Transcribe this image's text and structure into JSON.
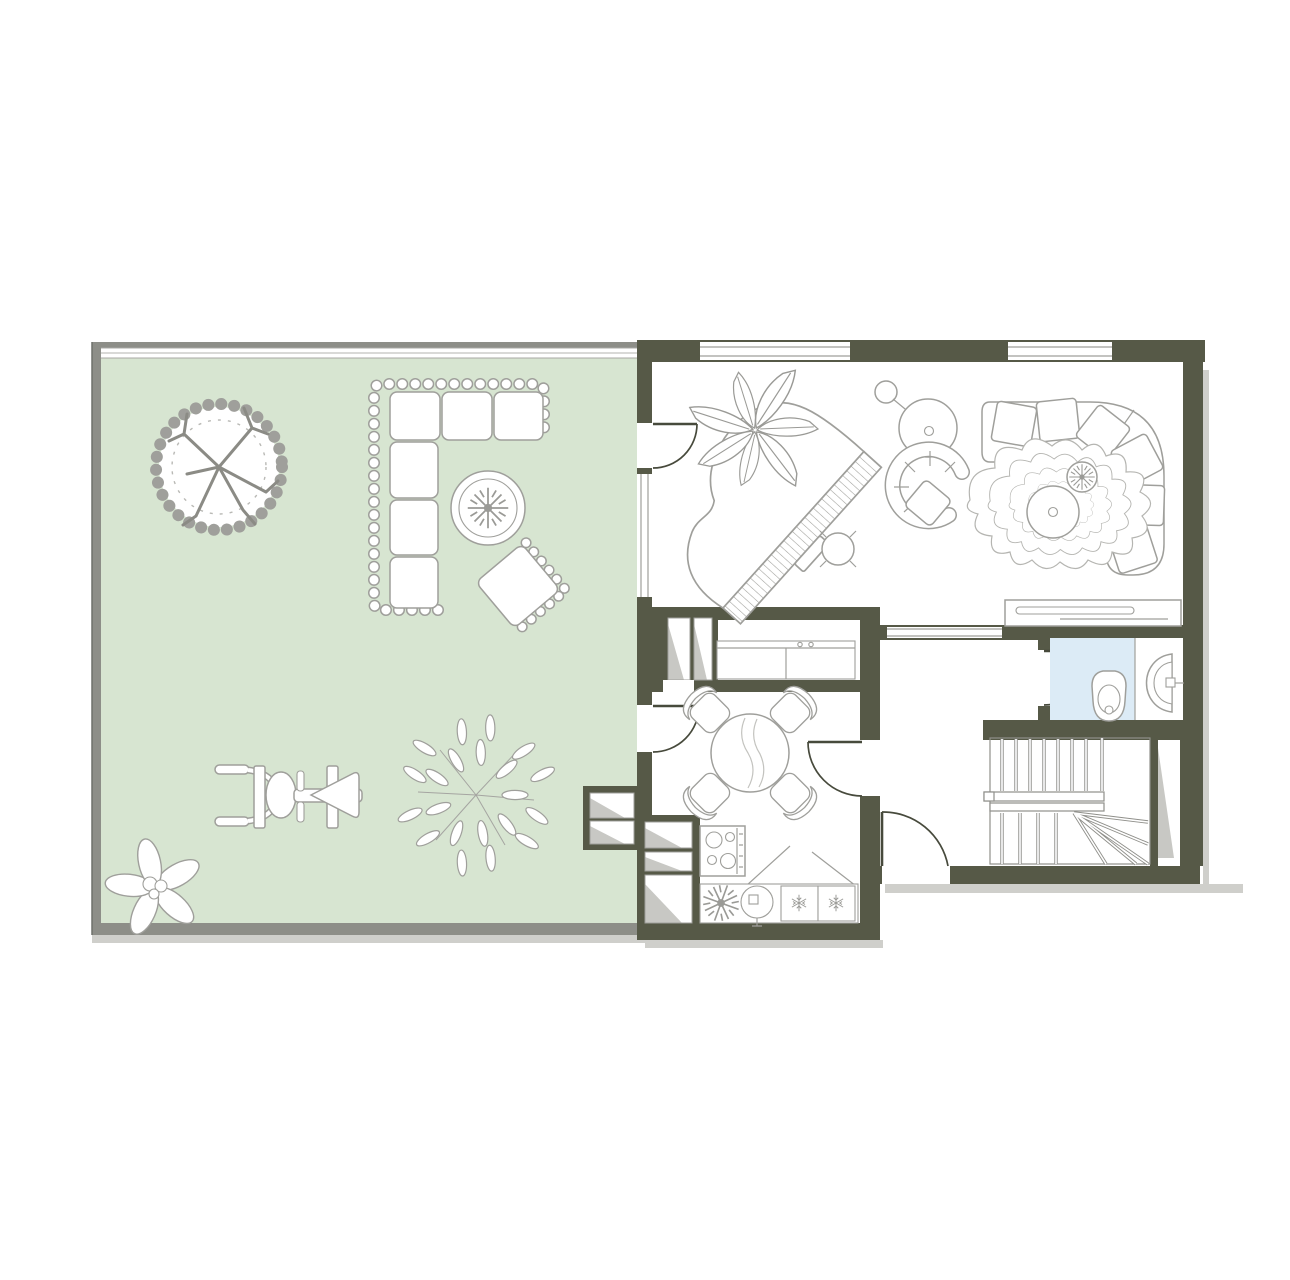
{
  "image": {
    "width": 1290,
    "height": 1280,
    "kind": "floor-plan"
  },
  "colors": {
    "wall": "#565947",
    "terrace": "#d7e5d1",
    "terrace_border": "#8d8e88",
    "bathroom_floor": "#dcebf6",
    "outline": "#9f9f9b",
    "outline_dark": "#8b8b85",
    "shaft": "#c8c8c4",
    "shadow": "#cfcfcb",
    "door": "#474a3c",
    "floor": "#ffffff",
    "stair": "#8f8f8a"
  },
  "rooms": {
    "terrace_garden": {
      "floor_color_key": "terrace",
      "features": [
        "tree",
        "leafy-bush",
        "flower",
        "outdoor-corner-sofa",
        "round-table-with-plant",
        "lounge-chair",
        "spring-rider"
      ],
      "sofa_cushions": 6,
      "fence_sides": 1
    },
    "living_room": {
      "features": [
        "grand-piano",
        "piano-stool",
        "potted-plant",
        "hanging-chair",
        "armchair",
        "curved-corner-sofa",
        "wavy-rug",
        "round-coffee-table",
        "rug-plant",
        "tv-console"
      ],
      "sofa_cushions": 6,
      "windows": 2,
      "doors": [
        "terrace-door"
      ]
    },
    "pantry": {
      "features": [
        "cabinet-counter"
      ],
      "vent_shafts": 2,
      "openings": [
        "passage-to-dining"
      ]
    },
    "dining_room": {
      "features": [
        "round-dining-table"
      ],
      "chairs": 4,
      "doors": [
        "terrace-door",
        "hallway-door"
      ],
      "vent_shafts_garden_side": 2
    },
    "kitchen": {
      "features": [
        "stove-4-burner",
        "round-sink",
        "fridge",
        "freezer",
        "plant",
        "counter"
      ],
      "vent_shafts": 3
    },
    "bathroom": {
      "floor_color_key": "bathroom_floor",
      "features": [
        "toilet",
        "half-round-wall-sink"
      ],
      "doors": [
        "hallway-door"
      ]
    },
    "hallway": {
      "doors": [
        "entrance-door"
      ],
      "openings": [
        "interior-window-to-living-room"
      ]
    },
    "staircase": {
      "flights": 2,
      "upper_treads": 7,
      "lower_treads": 4,
      "winder_treads": 4,
      "windows": 1
    }
  }
}
